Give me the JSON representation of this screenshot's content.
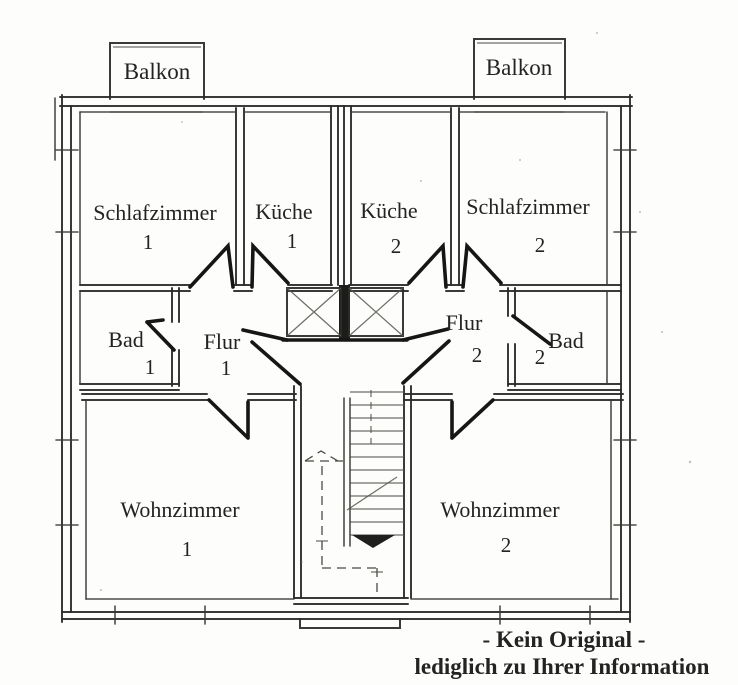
{
  "colors": {
    "ink": "#232321",
    "apartment1": "#d92b26",
    "apartment2": "#45bfdf",
    "disclaimer": "#e03a35"
  },
  "balconies": [
    {
      "label": "Balkon"
    },
    {
      "label": "Balkon"
    }
  ],
  "rooms": [
    {
      "id": "schlafzimmer-1",
      "label": "Schlafzimmer",
      "number": "1",
      "apartment": 1
    },
    {
      "id": "kueche-1",
      "label": "Küche",
      "number": "1",
      "apartment": 1
    },
    {
      "id": "kueche-2",
      "label": "Küche",
      "number": "2",
      "apartment": 2
    },
    {
      "id": "schlafzimmer-2",
      "label": "Schlafzimmer",
      "number": "2",
      "apartment": 2
    },
    {
      "id": "bad-1",
      "label": "Bad",
      "number": "1",
      "apartment": 1
    },
    {
      "id": "flur-1",
      "label": "Flur",
      "number": "1",
      "apartment": 1
    },
    {
      "id": "flur-2",
      "label": "Flur",
      "number": "2",
      "apartment": 2
    },
    {
      "id": "bad-2",
      "label": "Bad",
      "number": "2",
      "apartment": 2
    },
    {
      "id": "wohnzimmer-1",
      "label": "Wohnzimmer",
      "number": "1",
      "apartment": 1
    },
    {
      "id": "wohnzimmer-2",
      "label": "Wohnzimmer",
      "number": "2",
      "apartment": 2
    }
  ],
  "disclaimer": {
    "line1": "- Kein Original -",
    "line2": "lediglich zu Ihrer Information"
  }
}
